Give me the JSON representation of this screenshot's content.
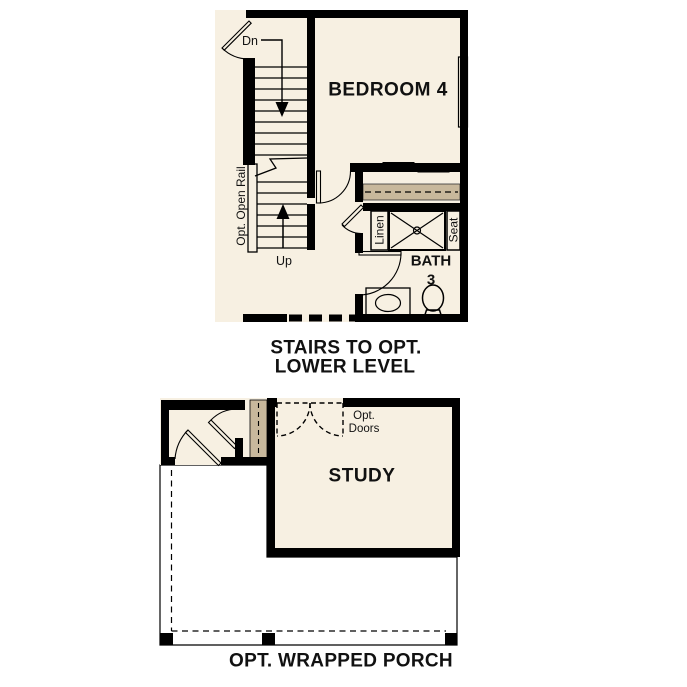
{
  "colors": {
    "bg": "#ffffff",
    "floor": "#f7f0e2",
    "wall": "#000000",
    "tan": "#c8b89c",
    "blue": "#aecbe9",
    "porch": "#e5e4e0",
    "ink": "#111111"
  },
  "upper_plan": {
    "bedroom_label": "BEDROOM 4",
    "stairs": {
      "down_label": "Dn",
      "up_label": "Up",
      "rail_label": "Opt. Open Rail"
    },
    "bath": {
      "name_line1": "BATH",
      "name_line2": "3",
      "linen_label": "Linen",
      "seat_label": "Seat"
    },
    "caption_line1": "STAIRS TO OPT.",
    "caption_line2": "LOWER LEVEL"
  },
  "lower_plan": {
    "study_label": "STUDY",
    "opt_doors_line1": "Opt.",
    "opt_doors_line2": "Doors",
    "caption": "OPT. WRAPPED PORCH"
  }
}
